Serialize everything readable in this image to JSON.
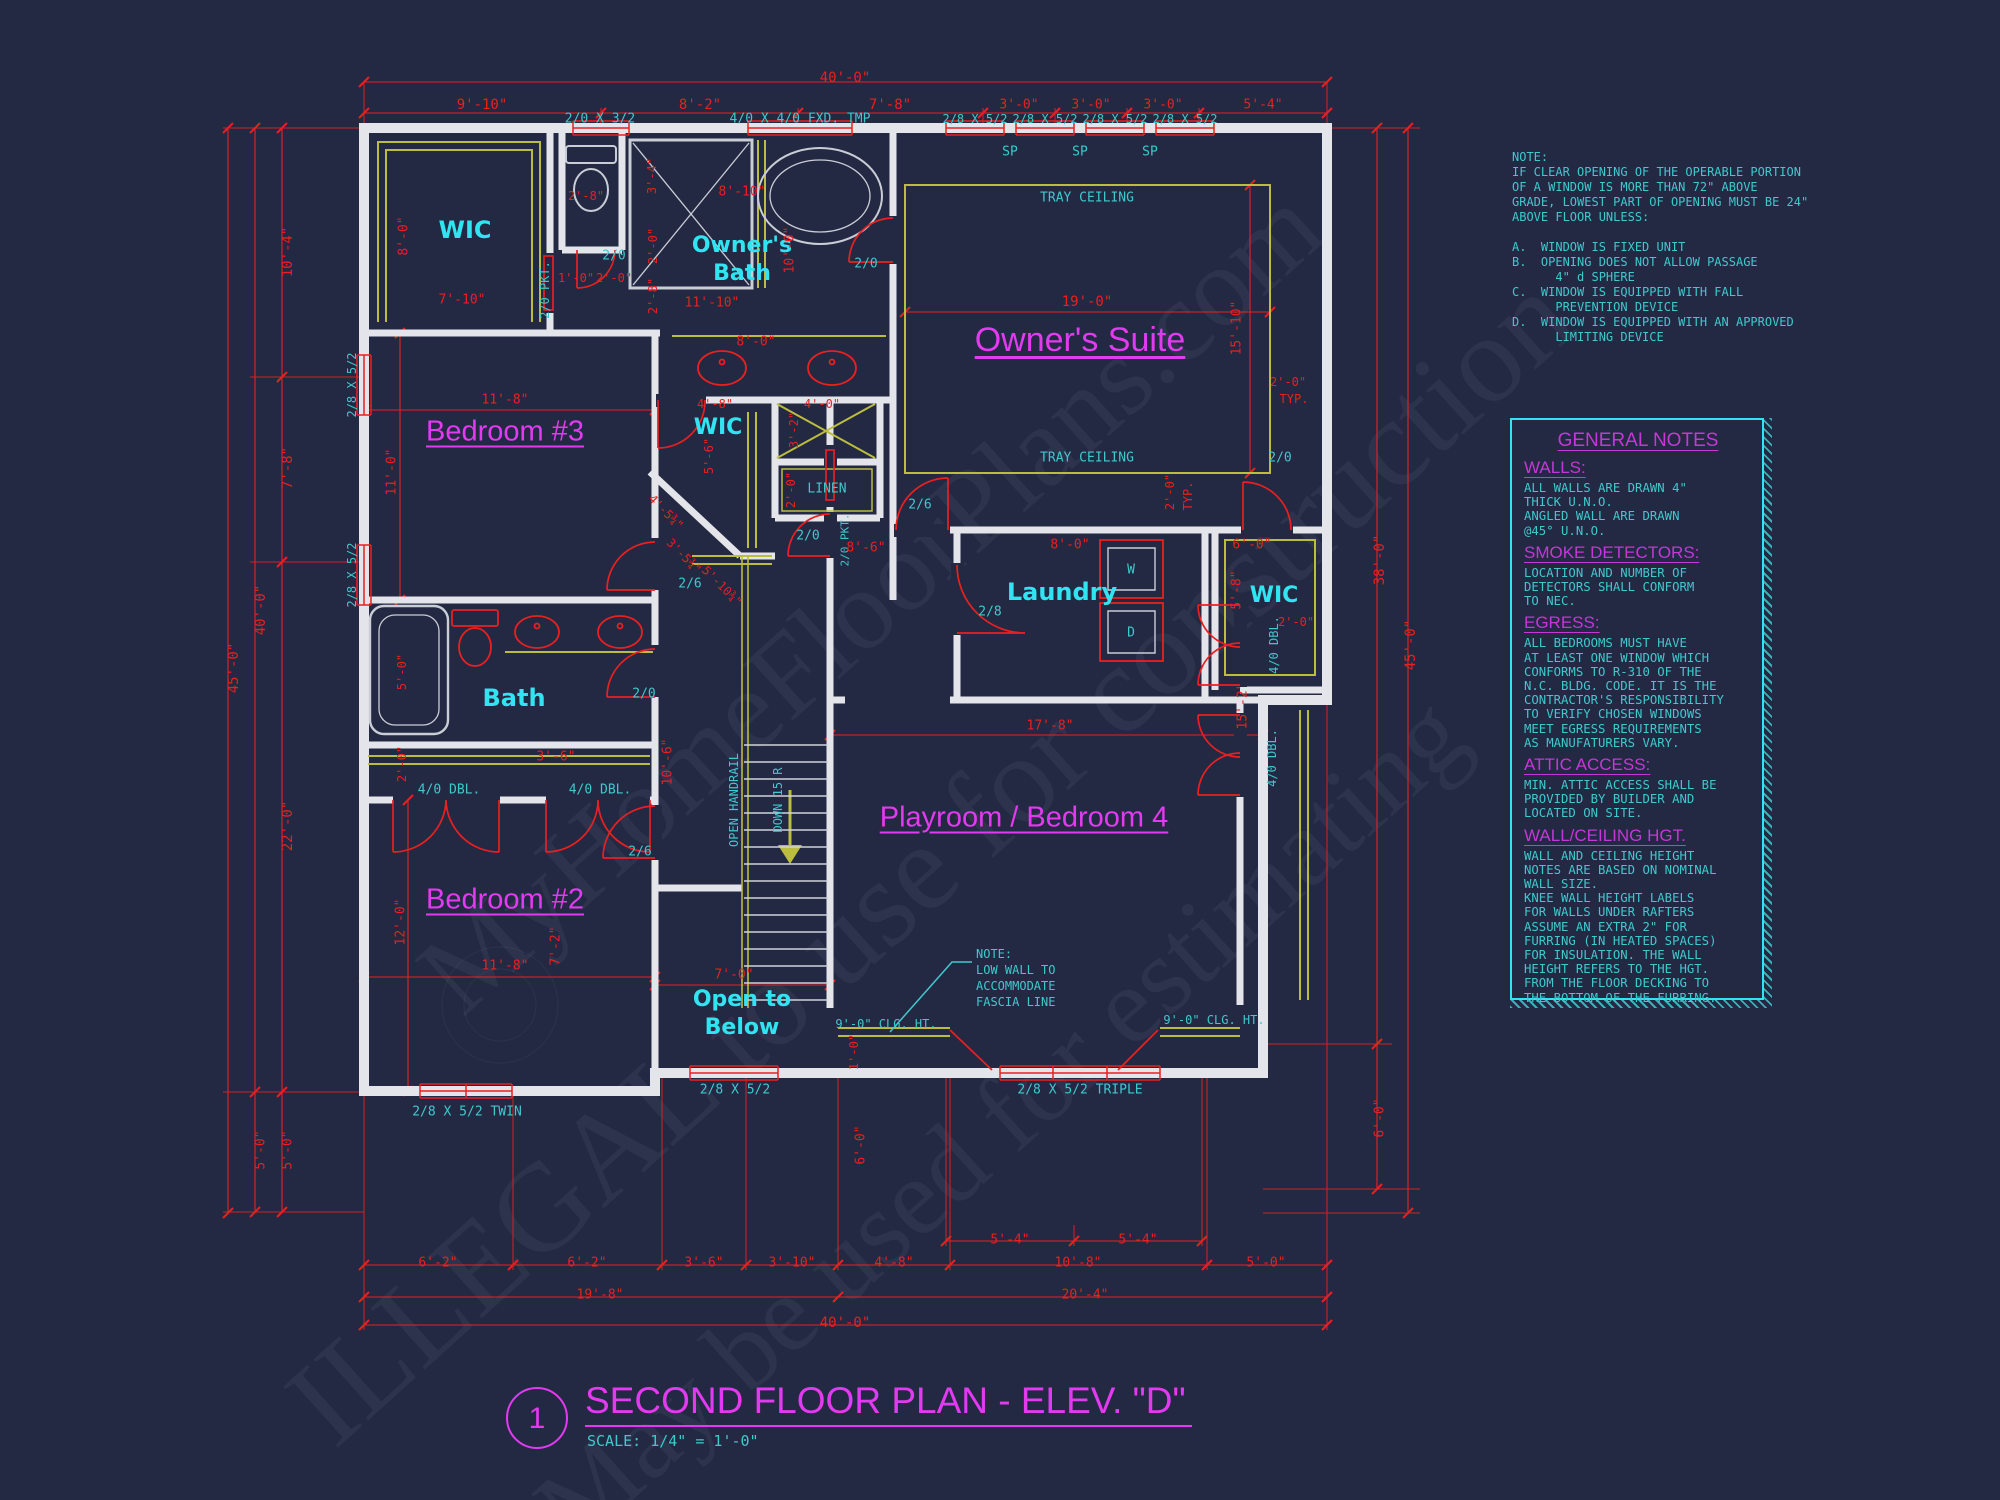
{
  "meta": {
    "sheet_number": "1",
    "title": "SECOND FLOOR PLAN - ELEV. \"D\"",
    "scale_label": "SCALE: 1/4\" = 1'-0\""
  },
  "watermark": {
    "lines": [
      "MyHomeFloorPlans.com",
      "ILLEGAL to use for construction",
      "May be used for estimating"
    ]
  },
  "window_note": {
    "lines": [
      "NOTE:",
      "IF CLEAR OPENING OF THE OPERABLE PORTION",
      "OF A WINDOW IS MORE THAN 72\" ABOVE",
      "GRADE, LOWEST PART OF OPENING MUST BE 24\"",
      "ABOVE FLOOR UNLESS:",
      "",
      "A.  WINDOW IS FIXED UNIT",
      "B.  OPENING DOES NOT ALLOW PASSAGE",
      "      4\" d SPHERE",
      "C.  WINDOW IS EQUIPPED WITH FALL",
      "      PREVENTION DEVICE",
      "D.  WINDOW IS EQUIPPED WITH AN APPROVED",
      "      LIMITING DEVICE"
    ]
  },
  "general_notes": {
    "title": "GENERAL NOTES",
    "sections": [
      {
        "heading": "WALLS:",
        "lines": [
          "ALL WALLS ARE DRAWN 4\"",
          "THICK U.N.O.",
          "ANGLED WALL ARE DRAWN",
          "@45° U.N.O."
        ]
      },
      {
        "heading": "SMOKE DETECTORS:",
        "lines": [
          "LOCATION AND NUMBER OF",
          "DETECTORS SHALL CONFORM",
          "TO NEC."
        ]
      },
      {
        "heading": "EGRESS:",
        "lines": [
          "ALL BEDROOMS MUST HAVE",
          "AT LEAST ONE WINDOW WHICH",
          "CONFORMS TO R-310 OF THE",
          "N.C. BLDG. CODE. IT IS THE",
          "CONTRACTOR'S RESPONSIBILITY",
          "TO VERIFY CHOSEN WINDOWS",
          "MEET EGRESS REQUIREMENTS",
          "AS MANUFATURERS VARY."
        ]
      },
      {
        "heading": "ATTIC ACCESS:",
        "lines": [
          "MIN. ATTIC ACCESS SHALL BE",
          "PROVIDED BY BUILDER AND",
          "LOCATED ON SITE."
        ]
      },
      {
        "heading": "WALL/CEILING HGT.",
        "lines": [
          "WALL AND CEILING HEIGHT",
          "NOTES ARE BASED ON NOMINAL",
          "WALL SIZE.",
          "KNEE WALL HEIGHT LABELS",
          "FOR WALLS UNDER RAFTERS",
          "ASSUME AN EXTRA 2\" FOR",
          "FURRING (IN HEATED SPACES)",
          "FOR INSULATION. THE WALL",
          "HEIGHT REFERS TO THE HGT.",
          "FROM THE FLOOR DECKING TO",
          "THE BOTTOM OF THE FURRING."
        ]
      }
    ]
  },
  "colors": {
    "background": "#232942",
    "dimension_red": "#ea2020",
    "annotation_cyan": "#3fc9ce",
    "room_cyan": "#31e4f2",
    "accent_magenta": "#e23af0",
    "shelf_yellow": "#bcbc3e",
    "wall_white": "#e3e5ea"
  },
  "labels": [
    {
      "t": "40'-0\"",
      "x": 845,
      "y": 78,
      "c": "red",
      "s": 14
    },
    {
      "t": "9'-10\"",
      "x": 482,
      "y": 105,
      "c": "red",
      "s": 14
    },
    {
      "t": "8'-2\"",
      "x": 700,
      "y": 105,
      "c": "red",
      "s": 14
    },
    {
      "t": "7'-8\"",
      "x": 890,
      "y": 105,
      "c": "red",
      "s": 14
    },
    {
      "t": "3'-0\"",
      "x": 1019,
      "y": 105,
      "c": "red",
      "s": 13
    },
    {
      "t": "3'-0\"",
      "x": 1091,
      "y": 105,
      "c": "red",
      "s": 13
    },
    {
      "t": "3'-0\"",
      "x": 1163,
      "y": 105,
      "c": "red",
      "s": 13
    },
    {
      "t": "5'-4\"",
      "x": 1263,
      "y": 105,
      "c": "red",
      "s": 13
    },
    {
      "t": "2/0 X 3/2",
      "x": 600,
      "y": 119,
      "c": "cyan",
      "s": 13,
      "n": "window-label"
    },
    {
      "t": "4/0 X 4/0 FXD. TMP",
      "x": 800,
      "y": 119,
      "c": "cyan",
      "s": 13,
      "n": "window-label"
    },
    {
      "t": "2/8 X 5/2",
      "x": 975,
      "y": 119,
      "c": "cyan",
      "s": 12,
      "n": "window-label"
    },
    {
      "t": "2/8 X 5/2",
      "x": 1045,
      "y": 119,
      "c": "cyan",
      "s": 12,
      "n": "window-label"
    },
    {
      "t": "2/8 X 5/2",
      "x": 1115,
      "y": 119,
      "c": "cyan",
      "s": 12,
      "n": "window-label"
    },
    {
      "t": "2/8 X 5/2",
      "x": 1185,
      "y": 119,
      "c": "cyan",
      "s": 12,
      "n": "window-label"
    },
    {
      "t": "SP",
      "x": 1010,
      "y": 152,
      "c": "cyan",
      "s": 13
    },
    {
      "t": "SP",
      "x": 1080,
      "y": 152,
      "c": "cyan",
      "s": 13
    },
    {
      "t": "SP",
      "x": 1150,
      "y": 152,
      "c": "cyan",
      "s": 13
    },
    {
      "t": "10'-4\"",
      "x": 288,
      "y": 252,
      "c": "red",
      "s": 14,
      "r": -90
    },
    {
      "t": "7'-8\"",
      "x": 288,
      "y": 468,
      "c": "red",
      "s": 14,
      "r": -90
    },
    {
      "t": "40'-0\"",
      "x": 261,
      "y": 610,
      "c": "red",
      "s": 14,
      "r": -90
    },
    {
      "t": "45'-0\"",
      "x": 234,
      "y": 668,
      "c": "red",
      "s": 14,
      "r": -90
    },
    {
      "t": "22'-0\"",
      "x": 288,
      "y": 826,
      "c": "red",
      "s": 14,
      "r": -90
    },
    {
      "t": "5'-0\"",
      "x": 261,
      "y": 1150,
      "c": "red",
      "s": 13,
      "r": -90
    },
    {
      "t": "5'-0\"",
      "x": 288,
      "y": 1150,
      "c": "red",
      "s": 13,
      "r": -90
    },
    {
      "t": "2/8 X 5/2",
      "x": 352,
      "y": 385,
      "c": "cyan",
      "s": 12,
      "r": -90,
      "n": "window-label"
    },
    {
      "t": "2/8 X 5/2",
      "x": 352,
      "y": 575,
      "c": "cyan",
      "s": 12,
      "r": -90,
      "n": "window-label"
    },
    {
      "t": "8'-0\"",
      "x": 404,
      "y": 236,
      "c": "red",
      "s": 13,
      "r": -90
    },
    {
      "t": "WIC",
      "x": 465,
      "y": 230,
      "c": "roomc",
      "s": 24,
      "n": "room-label-wic-1"
    },
    {
      "t": "7'-10\"",
      "x": 462,
      "y": 300,
      "c": "red",
      "s": 13
    },
    {
      "t": "2/0 PKT.",
      "x": 545,
      "y": 290,
      "c": "cyan",
      "s": 12,
      "r": -90,
      "n": "door-label"
    },
    {
      "t": "Bedroom #3",
      "x": 505,
      "y": 432,
      "c": "roomm",
      "s": 29,
      "u": 1,
      "n": "room-label-bedroom-3"
    },
    {
      "t": "11'-8\"",
      "x": 505,
      "y": 400,
      "c": "red",
      "s": 13
    },
    {
      "t": "11'-0\"",
      "x": 392,
      "y": 472,
      "c": "red",
      "s": 13,
      "r": -90
    },
    {
      "t": "2'-8\"",
      "x": 586,
      "y": 196,
      "c": "red",
      "s": 12
    },
    {
      "t": "3'-4\"",
      "x": 652,
      "y": 176,
      "c": "red",
      "s": 12,
      "r": -90
    },
    {
      "t": "8'-10\"",
      "x": 742,
      "y": 192,
      "c": "red",
      "s": 13
    },
    {
      "t": "2/0",
      "x": 614,
      "y": 256,
      "c": "cyan",
      "s": 13,
      "n": "door-label"
    },
    {
      "t": "2/0",
      "x": 866,
      "y": 264,
      "c": "cyan",
      "s": 13,
      "n": "door-label"
    },
    {
      "t": "Owner's",
      "x": 742,
      "y": 246,
      "c": "roomc",
      "s": 22,
      "n": "room-label-owners-bath"
    },
    {
      "t": "Bath",
      "x": 742,
      "y": 274,
      "c": "roomc",
      "s": 22
    },
    {
      "t": "2'-0\"",
      "x": 653,
      "y": 246,
      "c": "red",
      "s": 12,
      "r": -90
    },
    {
      "t": "2'-8\"",
      "x": 653,
      "y": 296,
      "c": "red",
      "s": 12,
      "r": -90
    },
    {
      "t": "1'-0\"",
      "x": 576,
      "y": 278,
      "c": "red",
      "s": 12
    },
    {
      "t": "2'-0\"",
      "x": 614,
      "y": 278,
      "c": "red",
      "s": 12
    },
    {
      "t": "11'-10\"",
      "x": 712,
      "y": 303,
      "c": "red",
      "s": 13
    },
    {
      "t": "10'-0\"",
      "x": 790,
      "y": 250,
      "c": "red",
      "s": 13,
      "r": -90
    },
    {
      "t": "8'-0\"",
      "x": 756,
      "y": 342,
      "c": "red",
      "s": 13
    },
    {
      "t": "TRAY CEILING",
      "x": 1087,
      "y": 198,
      "c": "cyan",
      "s": 13
    },
    {
      "t": "TRAY CEILING",
      "x": 1087,
      "y": 458,
      "c": "cyan",
      "s": 13
    },
    {
      "t": "19'-0\"",
      "x": 1087,
      "y": 302,
      "c": "red",
      "s": 14
    },
    {
      "t": "Owner's Suite",
      "x": 1080,
      "y": 340,
      "c": "roomm",
      "s": 34,
      "u": 1,
      "n": "room-label-owners-suite"
    },
    {
      "t": "15'-10\"",
      "x": 1237,
      "y": 328,
      "c": "red",
      "s": 13,
      "r": -90
    },
    {
      "t": "2'-0\"",
      "x": 1288,
      "y": 382,
      "c": "red",
      "s": 12
    },
    {
      "t": "TYP.",
      "x": 1294,
      "y": 399,
      "c": "red",
      "s": 12
    },
    {
      "t": "2'-0\"",
      "x": 1170,
      "y": 492,
      "c": "red",
      "s": 12,
      "r": -90
    },
    {
      "t": "TYP.",
      "x": 1188,
      "y": 496,
      "c": "red",
      "s": 12,
      "r": -90
    },
    {
      "t": "2/6",
      "x": 920,
      "y": 505,
      "c": "cyan",
      "s": 13,
      "n": "door-label"
    },
    {
      "t": "2/0",
      "x": 1280,
      "y": 458,
      "c": "cyan",
      "s": 13,
      "n": "door-label"
    },
    {
      "t": "WIC",
      "x": 718,
      "y": 428,
      "c": "roomc",
      "s": 22,
      "n": "room-label-wic-2"
    },
    {
      "t": "4'-8\"",
      "x": 715,
      "y": 404,
      "c": "red",
      "s": 12
    },
    {
      "t": "5'-6\"",
      "x": 709,
      "y": 456,
      "c": "red",
      "s": 12,
      "r": -90
    },
    {
      "t": "3'-2\"",
      "x": 794,
      "y": 430,
      "c": "red",
      "s": 12,
      "r": -90
    },
    {
      "t": "4'-0\"",
      "x": 822,
      "y": 404,
      "c": "red",
      "s": 12
    },
    {
      "t": "2'-0\"",
      "x": 791,
      "y": 490,
      "c": "red",
      "s": 12,
      "r": -90
    },
    {
      "t": "LINEN",
      "x": 827,
      "y": 489,
      "c": "cyan",
      "s": 13,
      "n": "room-label-linen"
    },
    {
      "t": "2/0 PKT.",
      "x": 845,
      "y": 540,
      "c": "cyan",
      "s": 11,
      "r": -90,
      "n": "door-label"
    },
    {
      "t": "2/0",
      "x": 808,
      "y": 536,
      "c": "cyan",
      "s": 13,
      "n": "door-label"
    },
    {
      "t": "8'-6\"",
      "x": 866,
      "y": 548,
      "c": "red",
      "s": 13
    },
    {
      "t": "2/6",
      "x": 690,
      "y": 584,
      "c": "cyan",
      "s": 13,
      "n": "door-label"
    },
    {
      "t": "4'-5¾\"",
      "x": 666,
      "y": 512,
      "c": "red",
      "s": 12,
      "r": 45
    },
    {
      "t": "3'-5¾\"",
      "x": 684,
      "y": 556,
      "c": "red",
      "s": 12,
      "r": 45
    },
    {
      "t": "5'-10¾\"",
      "x": 722,
      "y": 586,
      "c": "red",
      "s": 12,
      "r": 45
    },
    {
      "t": "3'-6\"",
      "x": 556,
      "y": 757,
      "c": "red",
      "s": 13
    },
    {
      "t": "10'-6\"",
      "x": 668,
      "y": 762,
      "c": "red",
      "s": 13,
      "r": -90
    },
    {
      "t": "7'-2\"",
      "x": 556,
      "y": 946,
      "c": "red",
      "s": 13,
      "r": -90
    },
    {
      "t": "Laundry",
      "x": 1062,
      "y": 592,
      "c": "roomc",
      "s": 24,
      "n": "room-label-laundry"
    },
    {
      "t": "8'-0\"",
      "x": 1070,
      "y": 545,
      "c": "red",
      "s": 13
    },
    {
      "t": "2/8",
      "x": 990,
      "y": 612,
      "c": "cyan",
      "s": 13,
      "n": "door-label"
    },
    {
      "t": "W",
      "x": 1131,
      "y": 570,
      "c": "cyan",
      "s": 13,
      "n": "washer-label"
    },
    {
      "t": "D",
      "x": 1131,
      "y": 633,
      "c": "cyan",
      "s": 13,
      "n": "dryer-label"
    },
    {
      "t": "6'-0\"",
      "x": 1252,
      "y": 545,
      "c": "red",
      "s": 13
    },
    {
      "t": "5'-8\"",
      "x": 1237,
      "y": 590,
      "c": "red",
      "s": 13,
      "r": -90
    },
    {
      "t": "WIC",
      "x": 1274,
      "y": 596,
      "c": "roomc",
      "s": 22,
      "n": "room-label-wic-3"
    },
    {
      "t": "2'-0\"",
      "x": 1296,
      "y": 622,
      "c": "red",
      "s": 12
    },
    {
      "t": "38'-0\"",
      "x": 1380,
      "y": 560,
      "c": "red",
      "s": 14,
      "r": -90
    },
    {
      "t": "45'-0\"",
      "x": 1411,
      "y": 645,
      "c": "red",
      "s": 14,
      "r": -90
    },
    {
      "t": "6'-0\"",
      "x": 1380,
      "y": 1118,
      "c": "red",
      "s": 13,
      "r": -90
    },
    {
      "t": "17'-8\"",
      "x": 1050,
      "y": 726,
      "c": "red",
      "s": 13
    },
    {
      "t": "Playroom / Bedroom 4",
      "x": 1024,
      "y": 818,
      "c": "roomm",
      "s": 29,
      "u": 1,
      "n": "room-label-playroom"
    },
    {
      "t": "4/0 DBL.",
      "x": 1274,
      "y": 645,
      "c": "cyan",
      "s": 12,
      "r": -90,
      "n": "door-label"
    },
    {
      "t": "4/0 DBL.",
      "x": 1272,
      "y": 758,
      "c": "cyan",
      "s": 12,
      "r": -90,
      "n": "door-label"
    },
    {
      "t": "15'-2\"",
      "x": 1243,
      "y": 706,
      "c": "red",
      "s": 13,
      "r": -90
    },
    {
      "t": "9'-0\" CLG. HT.",
      "x": 886,
      "y": 1024,
      "c": "cyan",
      "s": 12
    },
    {
      "t": "9'-0\" CLG. HT.",
      "x": 1214,
      "y": 1020,
      "c": "cyan",
      "s": 12
    },
    {
      "t": "NOTE:",
      "x": 976,
      "y": 954,
      "c": "cyan",
      "s": 12,
      "a": "l"
    },
    {
      "t": "LOW WALL TO",
      "x": 976,
      "y": 970,
      "c": "cyan",
      "s": 12,
      "a": "l"
    },
    {
      "t": "ACCOMMODATE",
      "x": 976,
      "y": 986,
      "c": "cyan",
      "s": 12,
      "a": "l"
    },
    {
      "t": "FASCIA LINE",
      "x": 976,
      "y": 1002,
      "c": "cyan",
      "s": 12,
      "a": "l"
    },
    {
      "t": "1'-0\"",
      "x": 854,
      "y": 1052,
      "c": "red",
      "s": 12,
      "r": -90
    },
    {
      "t": "6'-0\"",
      "x": 861,
      "y": 1145,
      "c": "red",
      "s": 13,
      "r": -90
    },
    {
      "t": "Bath",
      "x": 514,
      "y": 698,
      "c": "roomc",
      "s": 24,
      "n": "room-label-bath"
    },
    {
      "t": "5'-0\"",
      "x": 402,
      "y": 672,
      "c": "red",
      "s": 12,
      "r": -90
    },
    {
      "t": "2/0",
      "x": 644,
      "y": 694,
      "c": "cyan",
      "s": 13,
      "n": "door-label"
    },
    {
      "t": "2'-0\"",
      "x": 402,
      "y": 764,
      "c": "red",
      "s": 12,
      "r": -90
    },
    {
      "t": "4/0 DBL.",
      "x": 449,
      "y": 790,
      "c": "cyan",
      "s": 13,
      "n": "door-label"
    },
    {
      "t": "4/0 DBL.",
      "x": 600,
      "y": 790,
      "c": "cyan",
      "s": 13,
      "n": "door-label"
    },
    {
      "t": "2/6",
      "x": 640,
      "y": 852,
      "c": "cyan",
      "s": 13,
      "n": "door-label"
    },
    {
      "t": "12'-0\"",
      "x": 401,
      "y": 922,
      "c": "red",
      "s": 13,
      "r": -90
    },
    {
      "t": "Bedroom #2",
      "x": 505,
      "y": 900,
      "c": "roomm",
      "s": 29,
      "u": 1,
      "n": "room-label-bedroom-2"
    },
    {
      "t": "11'-8\"",
      "x": 505,
      "y": 966,
      "c": "red",
      "s": 13
    },
    {
      "t": "OPEN HANDRAIL",
      "x": 734,
      "y": 800,
      "c": "cyan",
      "s": 12,
      "r": -90
    },
    {
      "t": "DOWN 15 R",
      "x": 778,
      "y": 800,
      "c": "cyan",
      "s": 12,
      "r": -90
    },
    {
      "t": "7'-0\"",
      "x": 734,
      "y": 975,
      "c": "red",
      "s": 13
    },
    {
      "t": "Open to",
      "x": 742,
      "y": 1000,
      "c": "roomc",
      "s": 22,
      "n": "room-label-open-to-below"
    },
    {
      "t": "Below",
      "x": 742,
      "y": 1028,
      "c": "roomc",
      "s": 22
    },
    {
      "t": "2/8 X 5/2 TWIN",
      "x": 467,
      "y": 1112,
      "c": "cyan",
      "s": 13,
      "n": "window-label"
    },
    {
      "t": "2/8 X 5/2",
      "x": 735,
      "y": 1090,
      "c": "cyan",
      "s": 13,
      "n": "window-label"
    },
    {
      "t": "2/8 X 5/2 TRIPLE",
      "x": 1080,
      "y": 1090,
      "c": "cyan",
      "s": 13,
      "n": "window-label"
    },
    {
      "t": "5'-4\"",
      "x": 1010,
      "y": 1240,
      "c": "red",
      "s": 13
    },
    {
      "t": "5'-4\"",
      "x": 1138,
      "y": 1240,
      "c": "red",
      "s": 13
    },
    {
      "t": "6'-2\"",
      "x": 438,
      "y": 1263,
      "c": "red",
      "s": 13
    },
    {
      "t": "6'-2\"",
      "x": 587,
      "y": 1263,
      "c": "red",
      "s": 13
    },
    {
      "t": "3'-6\"",
      "x": 704,
      "y": 1263,
      "c": "red",
      "s": 13
    },
    {
      "t": "3'-10\"",
      "x": 792,
      "y": 1263,
      "c": "red",
      "s": 13
    },
    {
      "t": "4'-8\"",
      "x": 894,
      "y": 1263,
      "c": "red",
      "s": 13
    },
    {
      "t": "10'-8\"",
      "x": 1078,
      "y": 1263,
      "c": "red",
      "s": 13
    },
    {
      "t": "5'-0\"",
      "x": 1266,
      "y": 1263,
      "c": "red",
      "s": 13
    },
    {
      "t": "19'-8\"",
      "x": 600,
      "y": 1295,
      "c": "red",
      "s": 13
    },
    {
      "t": "20'-4\"",
      "x": 1085,
      "y": 1295,
      "c": "red",
      "s": 13
    },
    {
      "t": "40'-0\"",
      "x": 845,
      "y": 1323,
      "c": "red",
      "s": 14
    }
  ]
}
